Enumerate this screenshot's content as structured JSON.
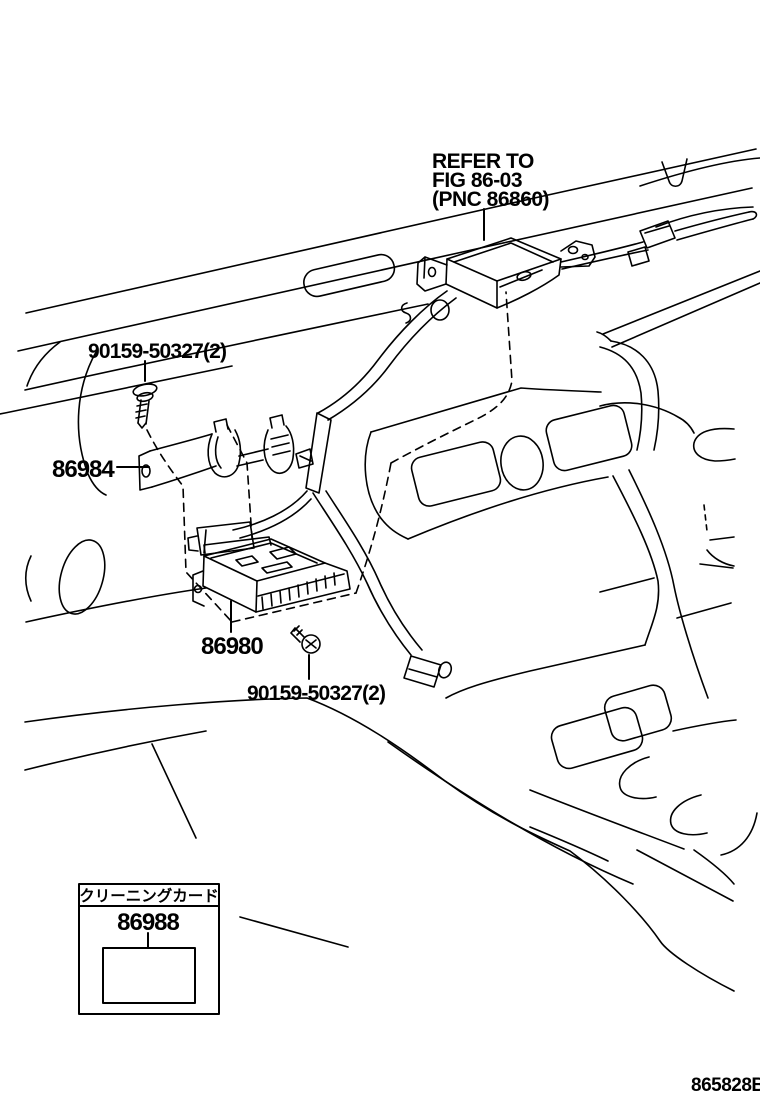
{
  "figure": {
    "background": "#ffffff",
    "line_color": "#000000",
    "note": {
      "line1": "REFER TO",
      "line2": "FIG 86-03",
      "line3": "(PNC 86860)"
    },
    "callouts": {
      "screw_upper": "90159-50327(2)",
      "bracket": "86984",
      "receiver": "86980",
      "screw_lower": "90159-50327(2)"
    },
    "legend": {
      "title": "クリーニングカード",
      "part": "86988"
    },
    "code": "865828B"
  }
}
